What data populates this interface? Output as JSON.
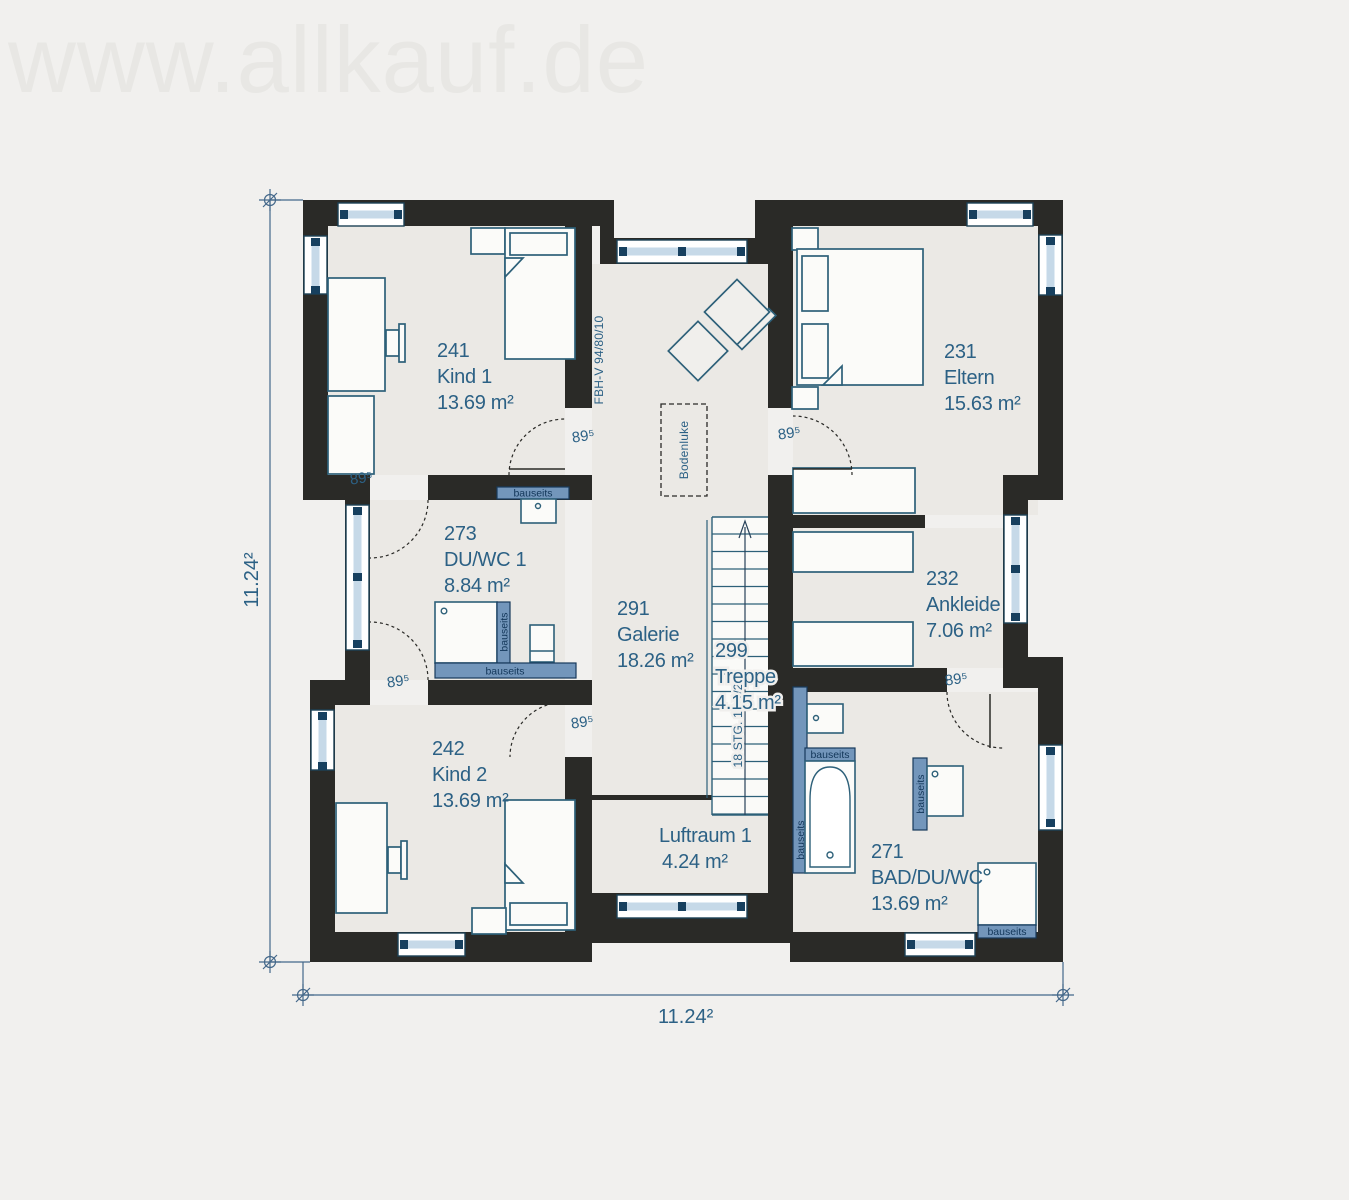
{
  "watermark": "www.allkauf.de",
  "dimensions": {
    "side": "11.24²",
    "bottom": "11.24²"
  },
  "rooms": {
    "kind1": {
      "number": "241",
      "name": "Kind 1",
      "area": "13.69 m²"
    },
    "eltern": {
      "number": "231",
      "name": "Eltern",
      "area": "15.63 m²"
    },
    "duwc1": {
      "number": "273",
      "name": "DU/WC 1",
      "area": "8.84 m²"
    },
    "galerie": {
      "number": "291",
      "name": "Galerie",
      "area": "18.26 m²"
    },
    "ankleide": {
      "number": "232",
      "name": "Ankleide",
      "area": "7.06 m²"
    },
    "treppe": {
      "number": "299",
      "name": "Treppe",
      "area": "4.15 m²"
    },
    "kind2": {
      "number": "242",
      "name": "Kind 2",
      "area": "13.69 m²"
    },
    "luftraum": {
      "name": "Luftraum 1",
      "area": "4.24 m²"
    },
    "bad": {
      "number": "271",
      "name": "BAD/DU/WC",
      "area": "13.69 m²"
    }
  },
  "annotations": {
    "door_width": "89⁵",
    "bauseits": "bauseits",
    "bodenluke": "Bodenluke",
    "floor_heating": "FBH-V 94/80/10",
    "stairs_spec": "18 STG. 18.1/25"
  },
  "colors": {
    "background": "#f1f0ee",
    "interior_floor": "#ebe9e5",
    "wall": "#2a2a27",
    "label_blue": "#2c6185",
    "fixture_blue": "#7396bb",
    "window_glass": "#c6d9e8",
    "window_mullion": "#17405f",
    "furniture_stroke": "#2d6079"
  }
}
